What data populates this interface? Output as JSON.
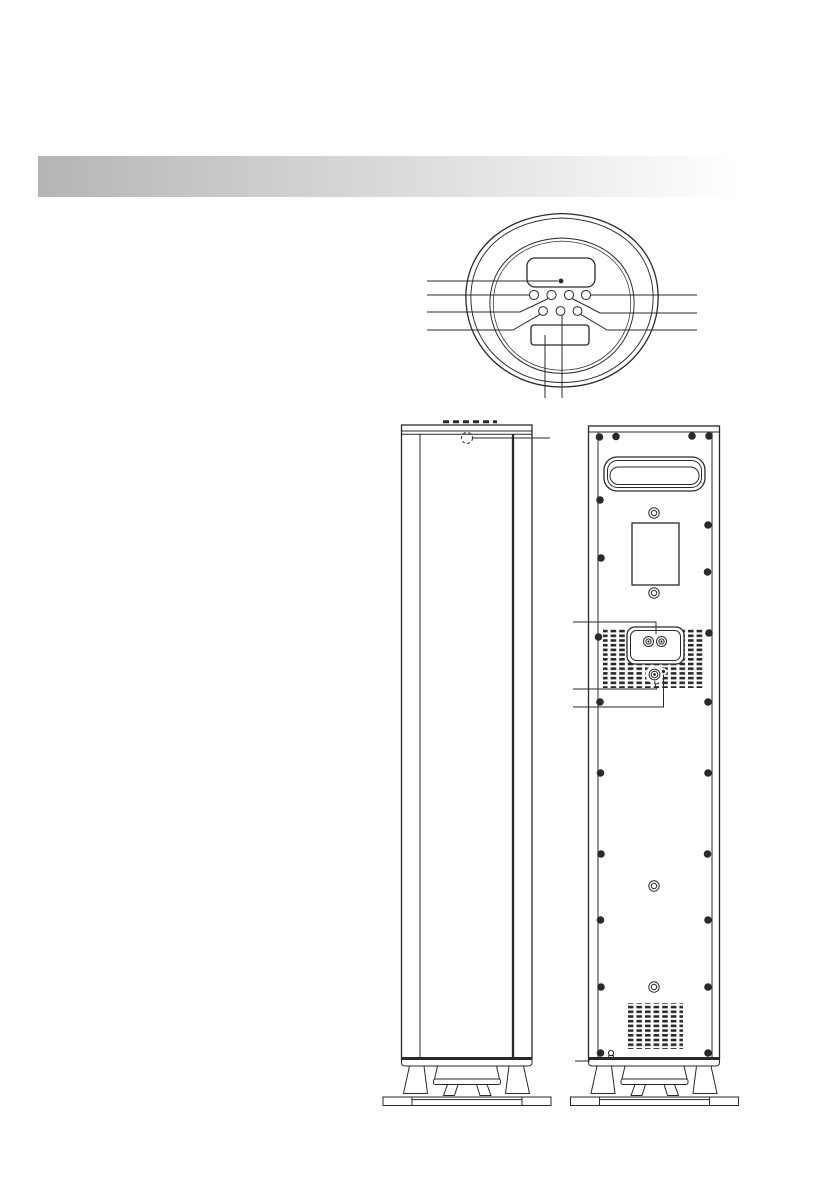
{
  "page": {
    "width": 839,
    "height": 1191,
    "background": "#ffffff"
  },
  "colors": {
    "line": "#2a2a2a",
    "header_start": "#b5b5b5",
    "header_end": "#ffffff",
    "background": "#ffffff"
  },
  "header": {
    "kind": "blank-gradient-section-bar"
  },
  "views": {
    "top": {
      "name": "speaker-top-view",
      "parts": [
        "display-window",
        "display-dot",
        "button-row-1 (4 round buttons)",
        "button-row-2 (3 round buttons)",
        "lower-panel"
      ],
      "buttons_row1": 4,
      "buttons_row2": 3,
      "callouts_left": 4,
      "callouts_right": 3,
      "callouts_bottom": 2
    },
    "front": {
      "name": "speaker-front-view",
      "parts": [
        "cabinet",
        "top-indicator (dashed circle)",
        "grille-seams",
        "pedestal",
        "base-plate"
      ],
      "callouts": 1
    },
    "back": {
      "name": "speaker-back-view",
      "parts": [
        "carry-handle-recess",
        "label-plate",
        "panel-screws",
        "center-ring-screws",
        "terminal-cup",
        "binding-posts",
        "vent-slots",
        "knob",
        "indicator-dot",
        "bottom-vent-grid",
        "bottom-connector",
        "pedestal",
        "base-plate"
      ],
      "binding_posts": 2,
      "ring_screws": 4,
      "panel_screws": 22,
      "callouts": 4
    }
  }
}
